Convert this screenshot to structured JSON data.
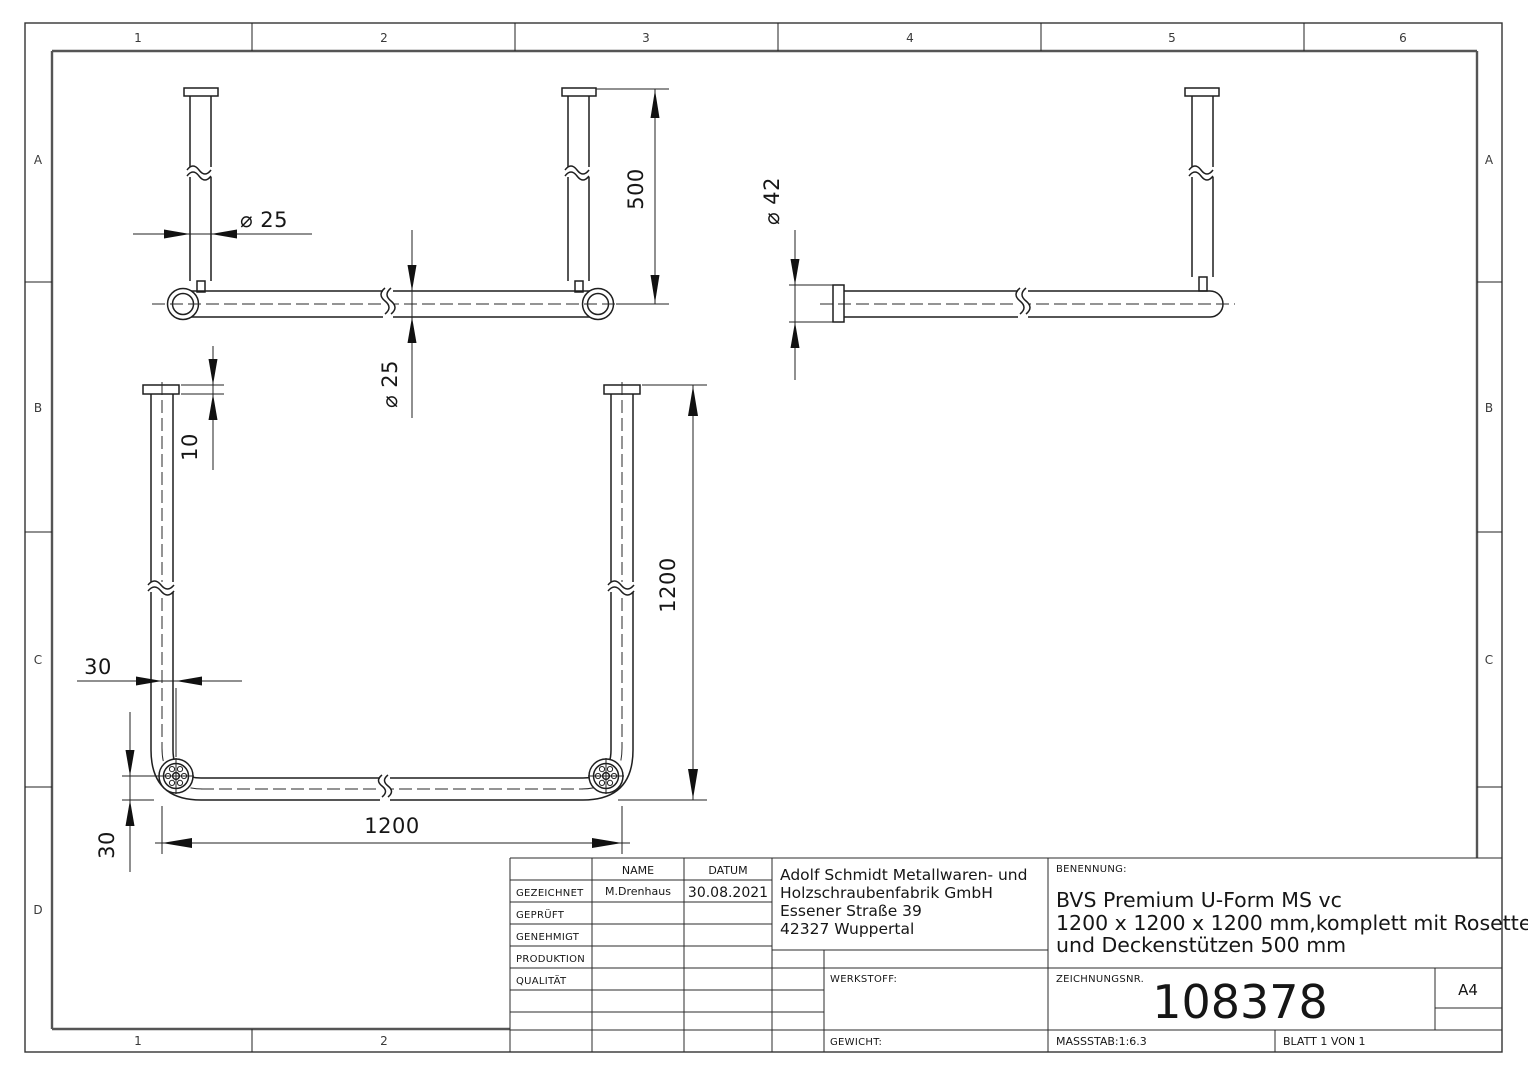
{
  "border": {
    "top_labels": [
      "1",
      "2",
      "3",
      "4",
      "5",
      "6"
    ],
    "bottom_labels": [
      "1",
      "2"
    ],
    "left_labels": [
      "A",
      "B",
      "C",
      "D"
    ],
    "right_labels": [
      "A",
      "B",
      "C"
    ]
  },
  "views": {
    "front": {
      "dim_support_diameter": "⌀ 25",
      "dim_support_length": "500",
      "dim_rail_diameter": "⌀ 25"
    },
    "side": {
      "dim_rosette_diameter": "⌀ 42"
    },
    "plan": {
      "dim_plate_thickness": "10",
      "dim_depth": "1200",
      "dim_width": "1200",
      "dim_offset_horizontal": "30",
      "dim_offset_vertical": "30"
    }
  },
  "title_block": {
    "name_header": "NAME",
    "date_header": "DATUM",
    "rows": [
      {
        "label": "GEZEICHNET",
        "name": "M.Drenhaus",
        "date": "30.08.2021"
      },
      {
        "label": "GEPRÜFT",
        "name": "",
        "date": ""
      },
      {
        "label": "GENEHMIGT",
        "name": "",
        "date": ""
      },
      {
        "label": "PRODUKTION",
        "name": "",
        "date": ""
      },
      {
        "label": "QUALITÄT",
        "name": "",
        "date": ""
      }
    ],
    "company_lines": [
      "Adolf Schmidt Metallwaren- und",
      "Holzschraubenfabrik GmbH",
      "Essener Straße 39",
      "42327 Wuppertal"
    ],
    "benennung_label": "BENENNUNG:",
    "benennung_lines": [
      "BVS Premium U-Form MS vc",
      "1200 x 1200 x 1200 mm,komplett mit Rosetten",
      "und Deckenstützen 500 mm"
    ],
    "werkstoff_label": "WERKSTOFF:",
    "gewicht_label": "GEWICHT:",
    "zeichnungsnr_label": "ZEICHNUNGSNR.",
    "drawing_number": "108378",
    "paper_size": "A4",
    "scale_label": "MASSSTAB:1:6.3",
    "sheet_label": "BLATT 1 VON 1"
  }
}
